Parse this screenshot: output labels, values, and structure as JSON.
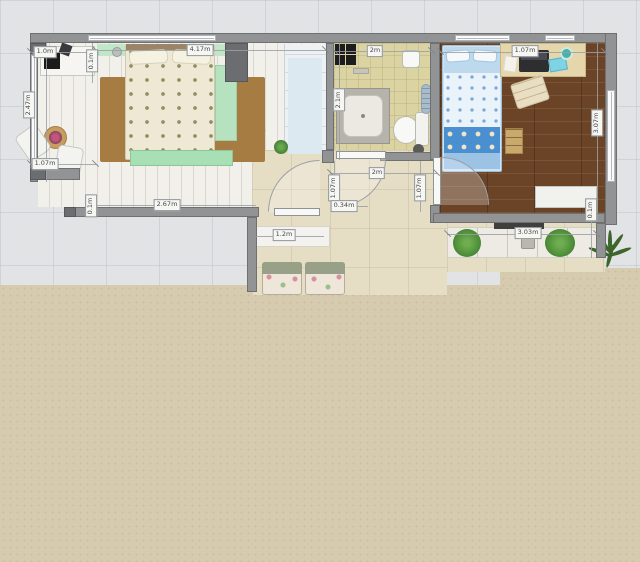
{
  "scene": {
    "kind": "apartment-floor-plan",
    "colors": {
      "grid_background": "#e1e3e5",
      "canvas_background": "#d6cbae",
      "wall": "#919395",
      "bedroom_floor": "#f2f0eb",
      "bathroom_floor": "#dbd4a2",
      "kids_room_floor": "#6b4428",
      "hallway_floor": "#e6ddc5",
      "accent_mint": "#b9e2c1",
      "accent_blue": "#4a8fd0",
      "rug_brown": "#a67c42"
    }
  },
  "dimensions": [
    {
      "id": "balcony-top",
      "text": "1.0m"
    },
    {
      "id": "balcony-left",
      "text": "2.47m"
    },
    {
      "id": "balcony-bottom",
      "text": "1.07m"
    },
    {
      "id": "left-wall-thickness",
      "text": "0.1m"
    },
    {
      "id": "bedroom-width",
      "text": "4.17m"
    },
    {
      "id": "bedroom-bottom",
      "text": "2.67m"
    },
    {
      "id": "bedroom-bottom-left",
      "text": "0.1m"
    },
    {
      "id": "bathroom-top",
      "text": "2m"
    },
    {
      "id": "bathroom-left",
      "text": "2.1m"
    },
    {
      "id": "hallway-width",
      "text": "2m"
    },
    {
      "id": "hall-door-left",
      "text": "1.07m"
    },
    {
      "id": "hall-offset",
      "text": "0.34m"
    },
    {
      "id": "hall-door-right",
      "text": "1.07m"
    },
    {
      "id": "living-opening",
      "text": "1.2m"
    },
    {
      "id": "kids-room-top",
      "text": "1.07m"
    },
    {
      "id": "kids-room-right",
      "text": "3.07m"
    },
    {
      "id": "kids-sill",
      "text": "3.03m"
    },
    {
      "id": "sill-thickness",
      "text": "0.1m"
    }
  ]
}
